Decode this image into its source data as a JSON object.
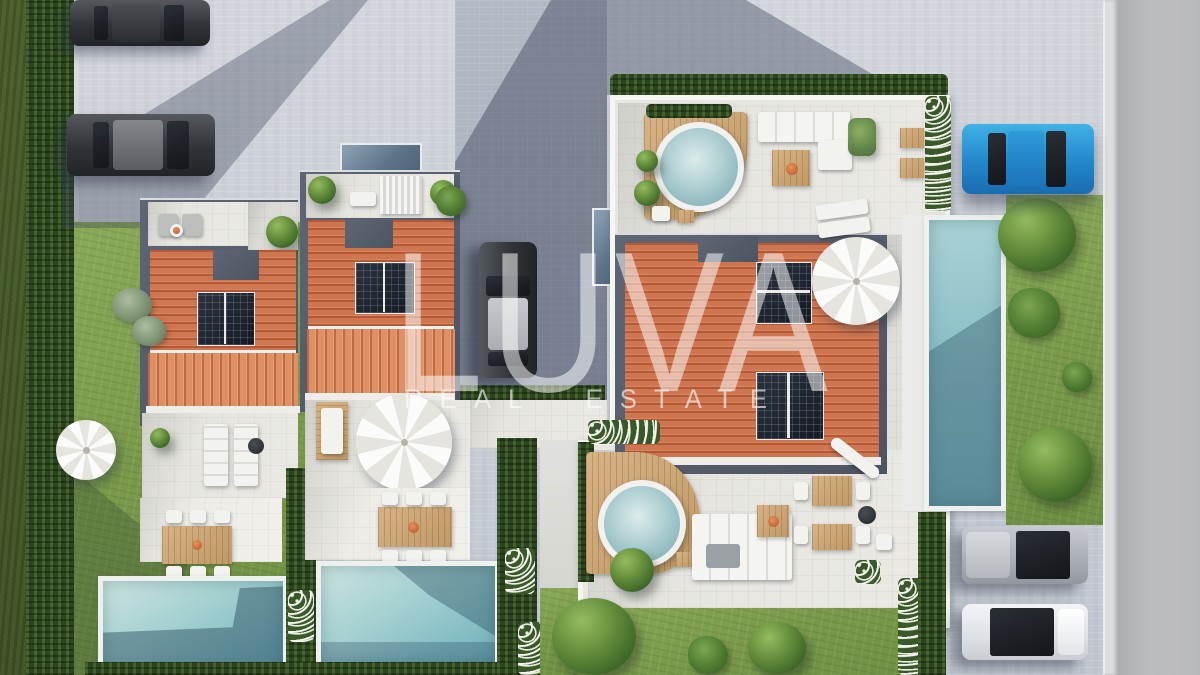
{
  "watermark": {
    "brand": "LUVA",
    "tagline": "REAL ESTATE"
  },
  "palette": {
    "paver_light": "#d6d9de",
    "paver_shadow": "#8e96a6",
    "road_gray": "#b5b6b8",
    "roof_terracotta": "#ce7650",
    "roof_terracotta_sunlit": "#dd9066",
    "slate_frame": "#565e6c",
    "solar_panel": "#1f2733",
    "pool_aqua": "#9fd0d2",
    "pool_shadow": "#44798e",
    "lawn_green": "#7a9a4a",
    "hedge_dark": "#2c441f",
    "wood_deck": "#c9a874",
    "terrace_white": "#f4f4f1",
    "car_graphite": "#33373c",
    "car_blue": "#2b9bd8",
    "car_silver": "#b9bdc3",
    "car_white": "#e9ebee",
    "watermark_white": "#ffffff"
  },
  "scene": {
    "type": "aerial-3d-architectural-render",
    "properties": [
      {
        "name": "twin-villa-left",
        "features": [
          "terracotta roof",
          "rooftop solar panels",
          "roof terrace",
          "patio with loungers",
          "outdoor dining table",
          "private pool"
        ]
      },
      {
        "name": "twin-villa-middle",
        "features": [
          "terracotta roof",
          "rooftop solar panels",
          "roof terrace with pergola",
          "patio with parasol",
          "outdoor dining table",
          "private pool"
        ]
      },
      {
        "name": "detached-villa-right",
        "features": [
          "terracotta roof",
          "rooftop solar panels",
          "two roof terraces",
          "two round hot tubs",
          "lounge and dining furniture",
          "side lap pool"
        ]
      }
    ],
    "vehicles": [
      {
        "name": "parked-car-top-1",
        "color": "graphite"
      },
      {
        "name": "parked-car-top-2",
        "color": "graphite"
      },
      {
        "name": "driveway-car-center",
        "color": "graphite"
      },
      {
        "name": "parked-car-right",
        "color": "blue"
      },
      {
        "name": "parked-car-bottom-1",
        "color": "silver"
      },
      {
        "name": "parked-car-bottom-2",
        "color": "white"
      }
    ],
    "pools": 3,
    "hot_tubs": 2
  }
}
